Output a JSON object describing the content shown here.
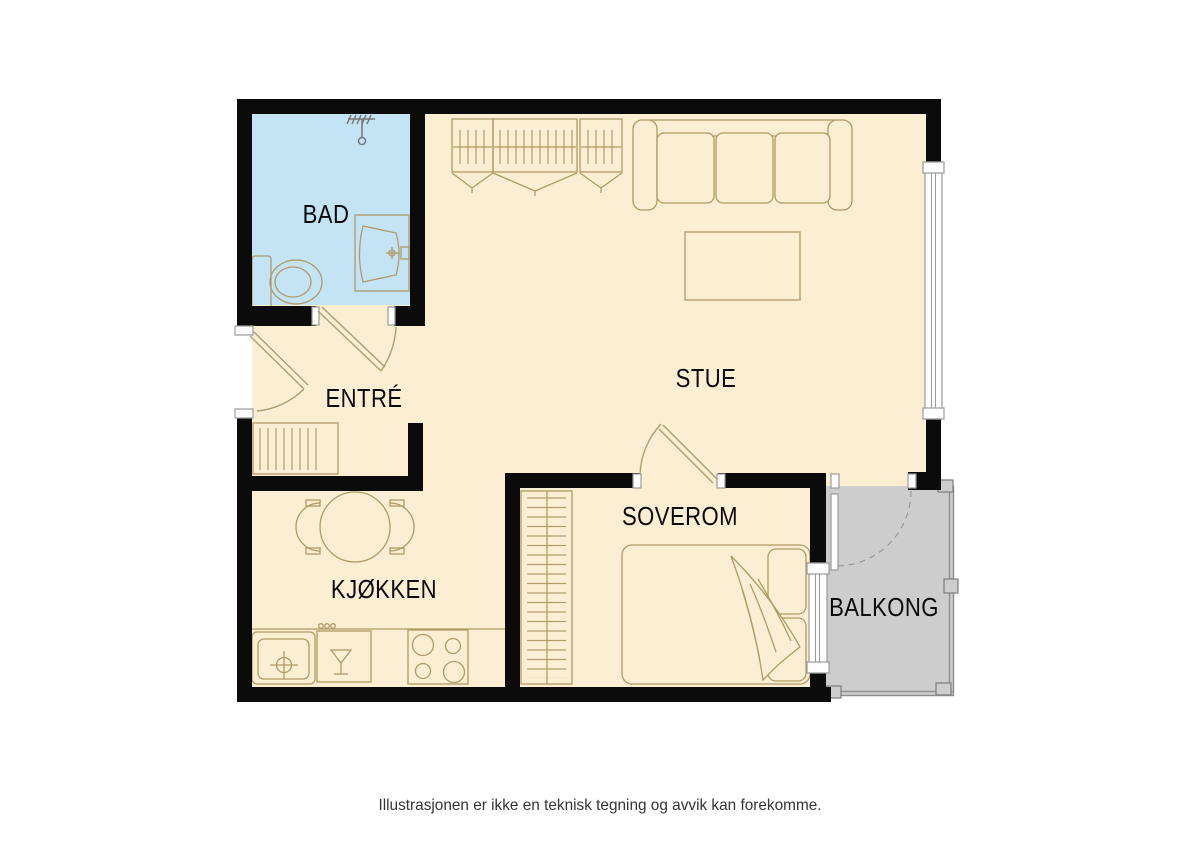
{
  "rooms": {
    "bad": "BAD",
    "entre": "ENTRÉ",
    "stue": "STUE",
    "kjokken": "KJØKKEN",
    "soverom": "SOVEROM",
    "balkong": "BALKONG"
  },
  "caption": "Illustrasjonen er ikke en teknisk tegning og avvik kan forekomme.",
  "colors": {
    "floor": "#FBEED3",
    "bathroom": "#C4E4F6",
    "balcony": "#CDCDCD",
    "walls": "#0B0B0B",
    "furniture_line": "#B09A66"
  }
}
